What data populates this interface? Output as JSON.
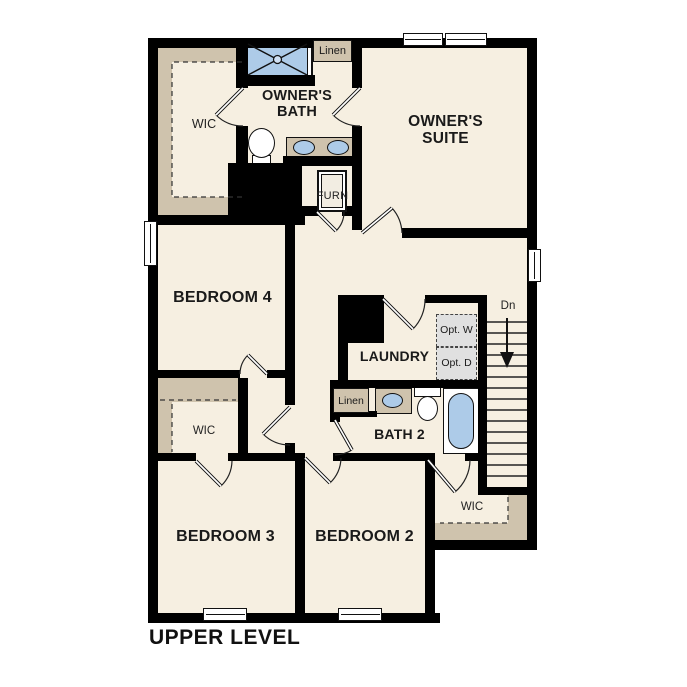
{
  "plan": {
    "title": "UPPER LEVEL",
    "rooms": {
      "owners_suite": "OWNER'S SUITE",
      "owners_bath": "OWNER'S BATH",
      "wic_owners": "WIC",
      "bedroom4": "BEDROOM 4",
      "bedroom3": "BEDROOM 3",
      "bedroom2": "BEDROOM 2",
      "laundry": "LAUNDRY",
      "bath2": "BATH 2",
      "wic_hall": "WIC",
      "wic_bedroom2": "WIC"
    },
    "labels": {
      "linen_top": "Linen",
      "linen_bath2": "Linen",
      "furnace": "FURN",
      "opt_washer": "Opt. W",
      "opt_dryer": "Opt. D",
      "stairs_down": "Dn"
    },
    "colors": {
      "wall": "#000000",
      "floor": "#f6efe1",
      "closet": "#cfc3ad",
      "fixture_blue": "#adcbe8",
      "optional_gray": "#e0e0e0",
      "text": "#1a1a1a",
      "background": "#ffffff"
    }
  }
}
